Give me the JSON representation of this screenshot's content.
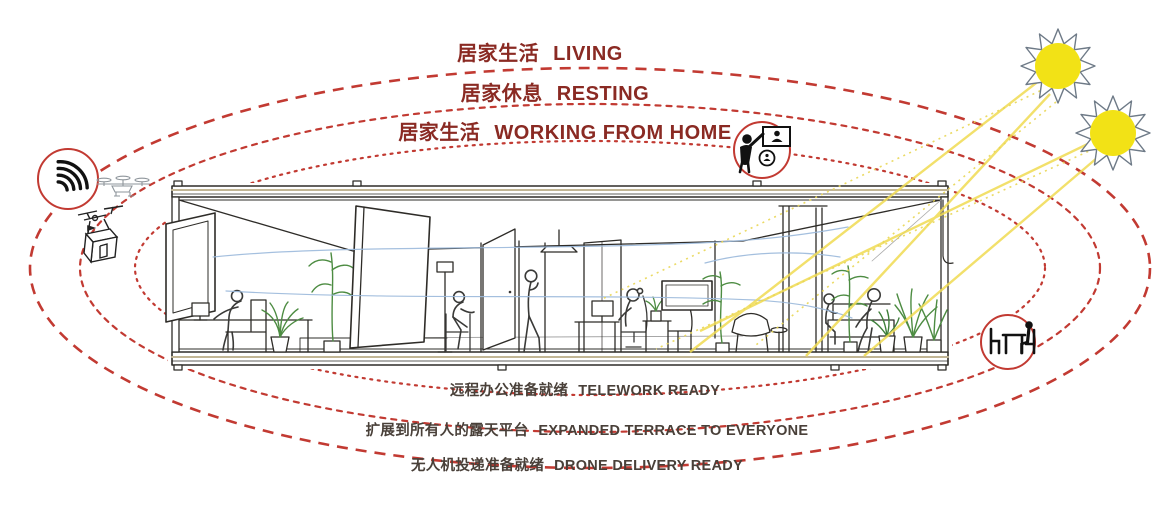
{
  "diagram_title": "Home cross-section lifestyle diagram",
  "orbit_labels_top": [
    {
      "zh": "居家生活",
      "en": "LIVING"
    },
    {
      "zh": "居家休息",
      "en": "RESTING"
    },
    {
      "zh": "居家生活",
      "en": "WORKING FROM HOME"
    }
  ],
  "orbit_labels_bottom": [
    {
      "zh": "远程办公准备就绪",
      "en": "TELEWORK READY"
    },
    {
      "zh": "扩展到所有人的露天平台",
      "en": "EXPANDED TERRACE TO EVERYONE"
    },
    {
      "zh": "无人机投递准备就绪",
      "en": "DRONE DELIVERY READY"
    }
  ],
  "icons": {
    "wifi": "wifi-signal",
    "drone_sketch": "drone-top-view",
    "delivery_drone": "drone-carrying-package",
    "video_call": "person-video-calling",
    "telework_desk": "person-at-desk",
    "sun": "sun"
  },
  "colors": {
    "orbit_red": "#c23a32",
    "label_top_red": "#8a2a23",
    "label_bottom_gray": "#494039",
    "sun_yellow": "#f2e216",
    "ray_yellow": "#f0db52",
    "plant_green": "#4d8c42",
    "airflow_blue": "#9bb9db",
    "ink": "#2e2c28"
  }
}
